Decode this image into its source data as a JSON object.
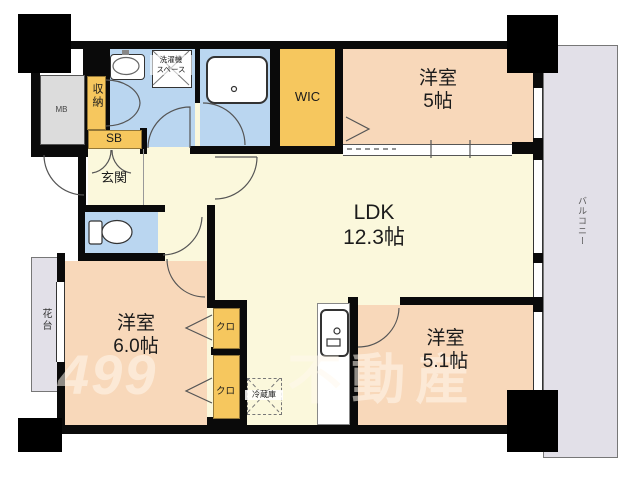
{
  "title": "間取り図",
  "rooms": {
    "ldk": {
      "label": "LDK",
      "size": "12.3帖"
    },
    "bedroom5": {
      "label": "洋室",
      "size": "5帖"
    },
    "bedroom60": {
      "label": "洋室",
      "size": "6.0帖"
    },
    "bedroom51": {
      "label": "洋室",
      "size": "5.1帖"
    },
    "entrance": {
      "label": "玄関"
    },
    "wic": {
      "label": "WIC"
    },
    "storage": {
      "label": "収納"
    },
    "shoe_box": {
      "label": "SB"
    },
    "meter_box": {
      "label": "MB"
    },
    "closet_upper": {
      "label": "クロ"
    },
    "closet_lower": {
      "label": "クロ"
    },
    "balcony": {
      "label": "バルコニー"
    },
    "flower_stand": {
      "label": "花台"
    },
    "washer_space": {
      "label_line1": "洗濯機",
      "label_line2": "スペース"
    },
    "refrigerator": {
      "label": "冷蔵庫"
    }
  },
  "watermark": {
    "logo": "499",
    "text": "不動産"
  },
  "colors": {
    "room_peach": "#f8d8ba",
    "room_cream": "#fbf8dc",
    "wet_blue": "#bad6f0",
    "storage_orange": "#f6c75e",
    "balcony_gray": "#e2e0e8",
    "meter_gray": "#dcdcdc",
    "wall_black": "#0a0a0a"
  }
}
